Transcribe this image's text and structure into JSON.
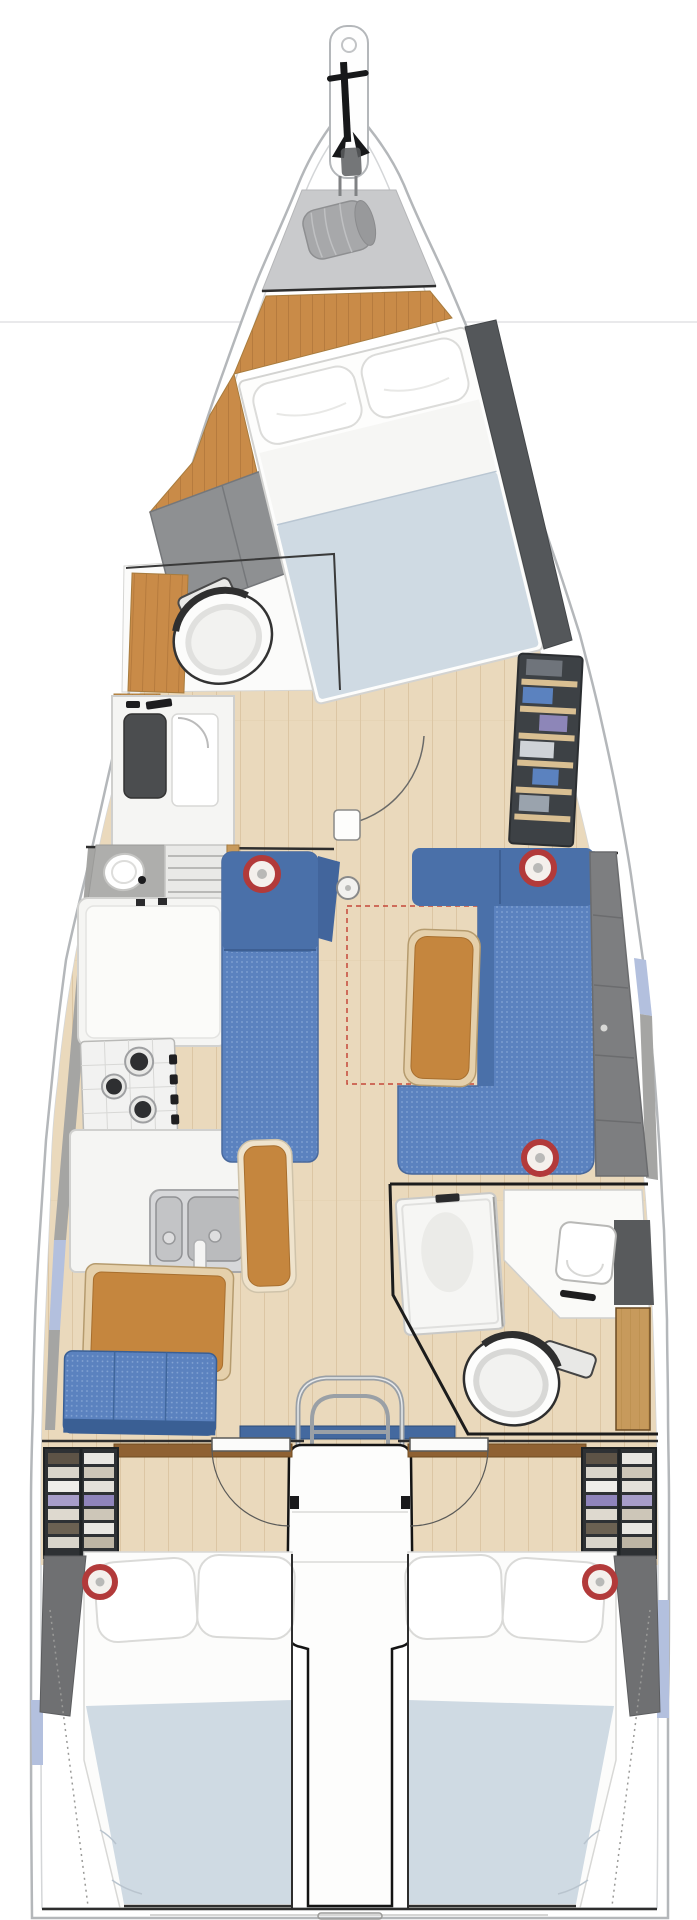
{
  "diagram": {
    "title": "Sailboat interior deck plan, bow up",
    "type": "yacht-floor-plan",
    "orientation": "bow-up",
    "counts": {
      "cabins": 3,
      "heads": 2,
      "berths": 3,
      "stove_burners": 3,
      "speaker_grilles": 5,
      "sink_bowls": 4
    }
  },
  "zones": {
    "bow": "Bowsprit with anchor",
    "sail_locker": "Sail locker with sail bag",
    "forward_cabin": "Forward owner cabin with double berth",
    "forward_head": "Forward head with toilet, vanity and shower",
    "saloon": "Saloon with settee, L-shaped sofa and table",
    "galley": "L-shaped galley with 3-burner stove and double sink",
    "nav_station": "Chart table with navigator seat",
    "aft_head": "Aft head with shower, sink and toilet",
    "companionway": "Companionway ladder and engine box",
    "aft_cabin_port": "Port aft cabin with double berth and wardrobe",
    "aft_cabin_starboard": "Starboard aft cabin with double berth and wardrobe"
  },
  "colors": {
    "hull_stroke": "#b4b7ba",
    "hull_inner": "#d4d6d8",
    "deck": "#ffffff",
    "locker_gray": "#c9cacc",
    "bag_gray": "#a7a8aa",
    "wood_orange": "#c98b48",
    "wood_orange_dark": "#b0763a",
    "floor": "#ead9bc",
    "floor_line": "#dcc6a4",
    "upholstery": "#5b82bf",
    "upholstery_dot": "#85a5d4",
    "upholstery_dark": "#4a70a9",
    "navy_edge": "#3a5f94",
    "mattress": "#cfdae3",
    "pillow": "#ffffff",
    "cushion_gray": "#7d7e80",
    "panel_gray": "#8e9092",
    "bolster_gray": "#6f7072",
    "leather": "#c5863e",
    "leather_trim": "#e5d0ab",
    "periwinkle": "#b3c0de",
    "steel": "#d7d8da",
    "dark_line": "#2e2e2e",
    "speaker_red": "#b23a3a",
    "door_wood": "#c79a5c",
    "wardrobe_dark": "#2e3134",
    "shelf_wood": "#d9bf92",
    "counter_white": "#f5f5f3",
    "stove_dark": "#2e2f31",
    "sill_blue": "#44699f",
    "chrome": "#9aa0a6",
    "gray_wedge": "#a5a5a3",
    "dash_red": "#c0392b"
  }
}
